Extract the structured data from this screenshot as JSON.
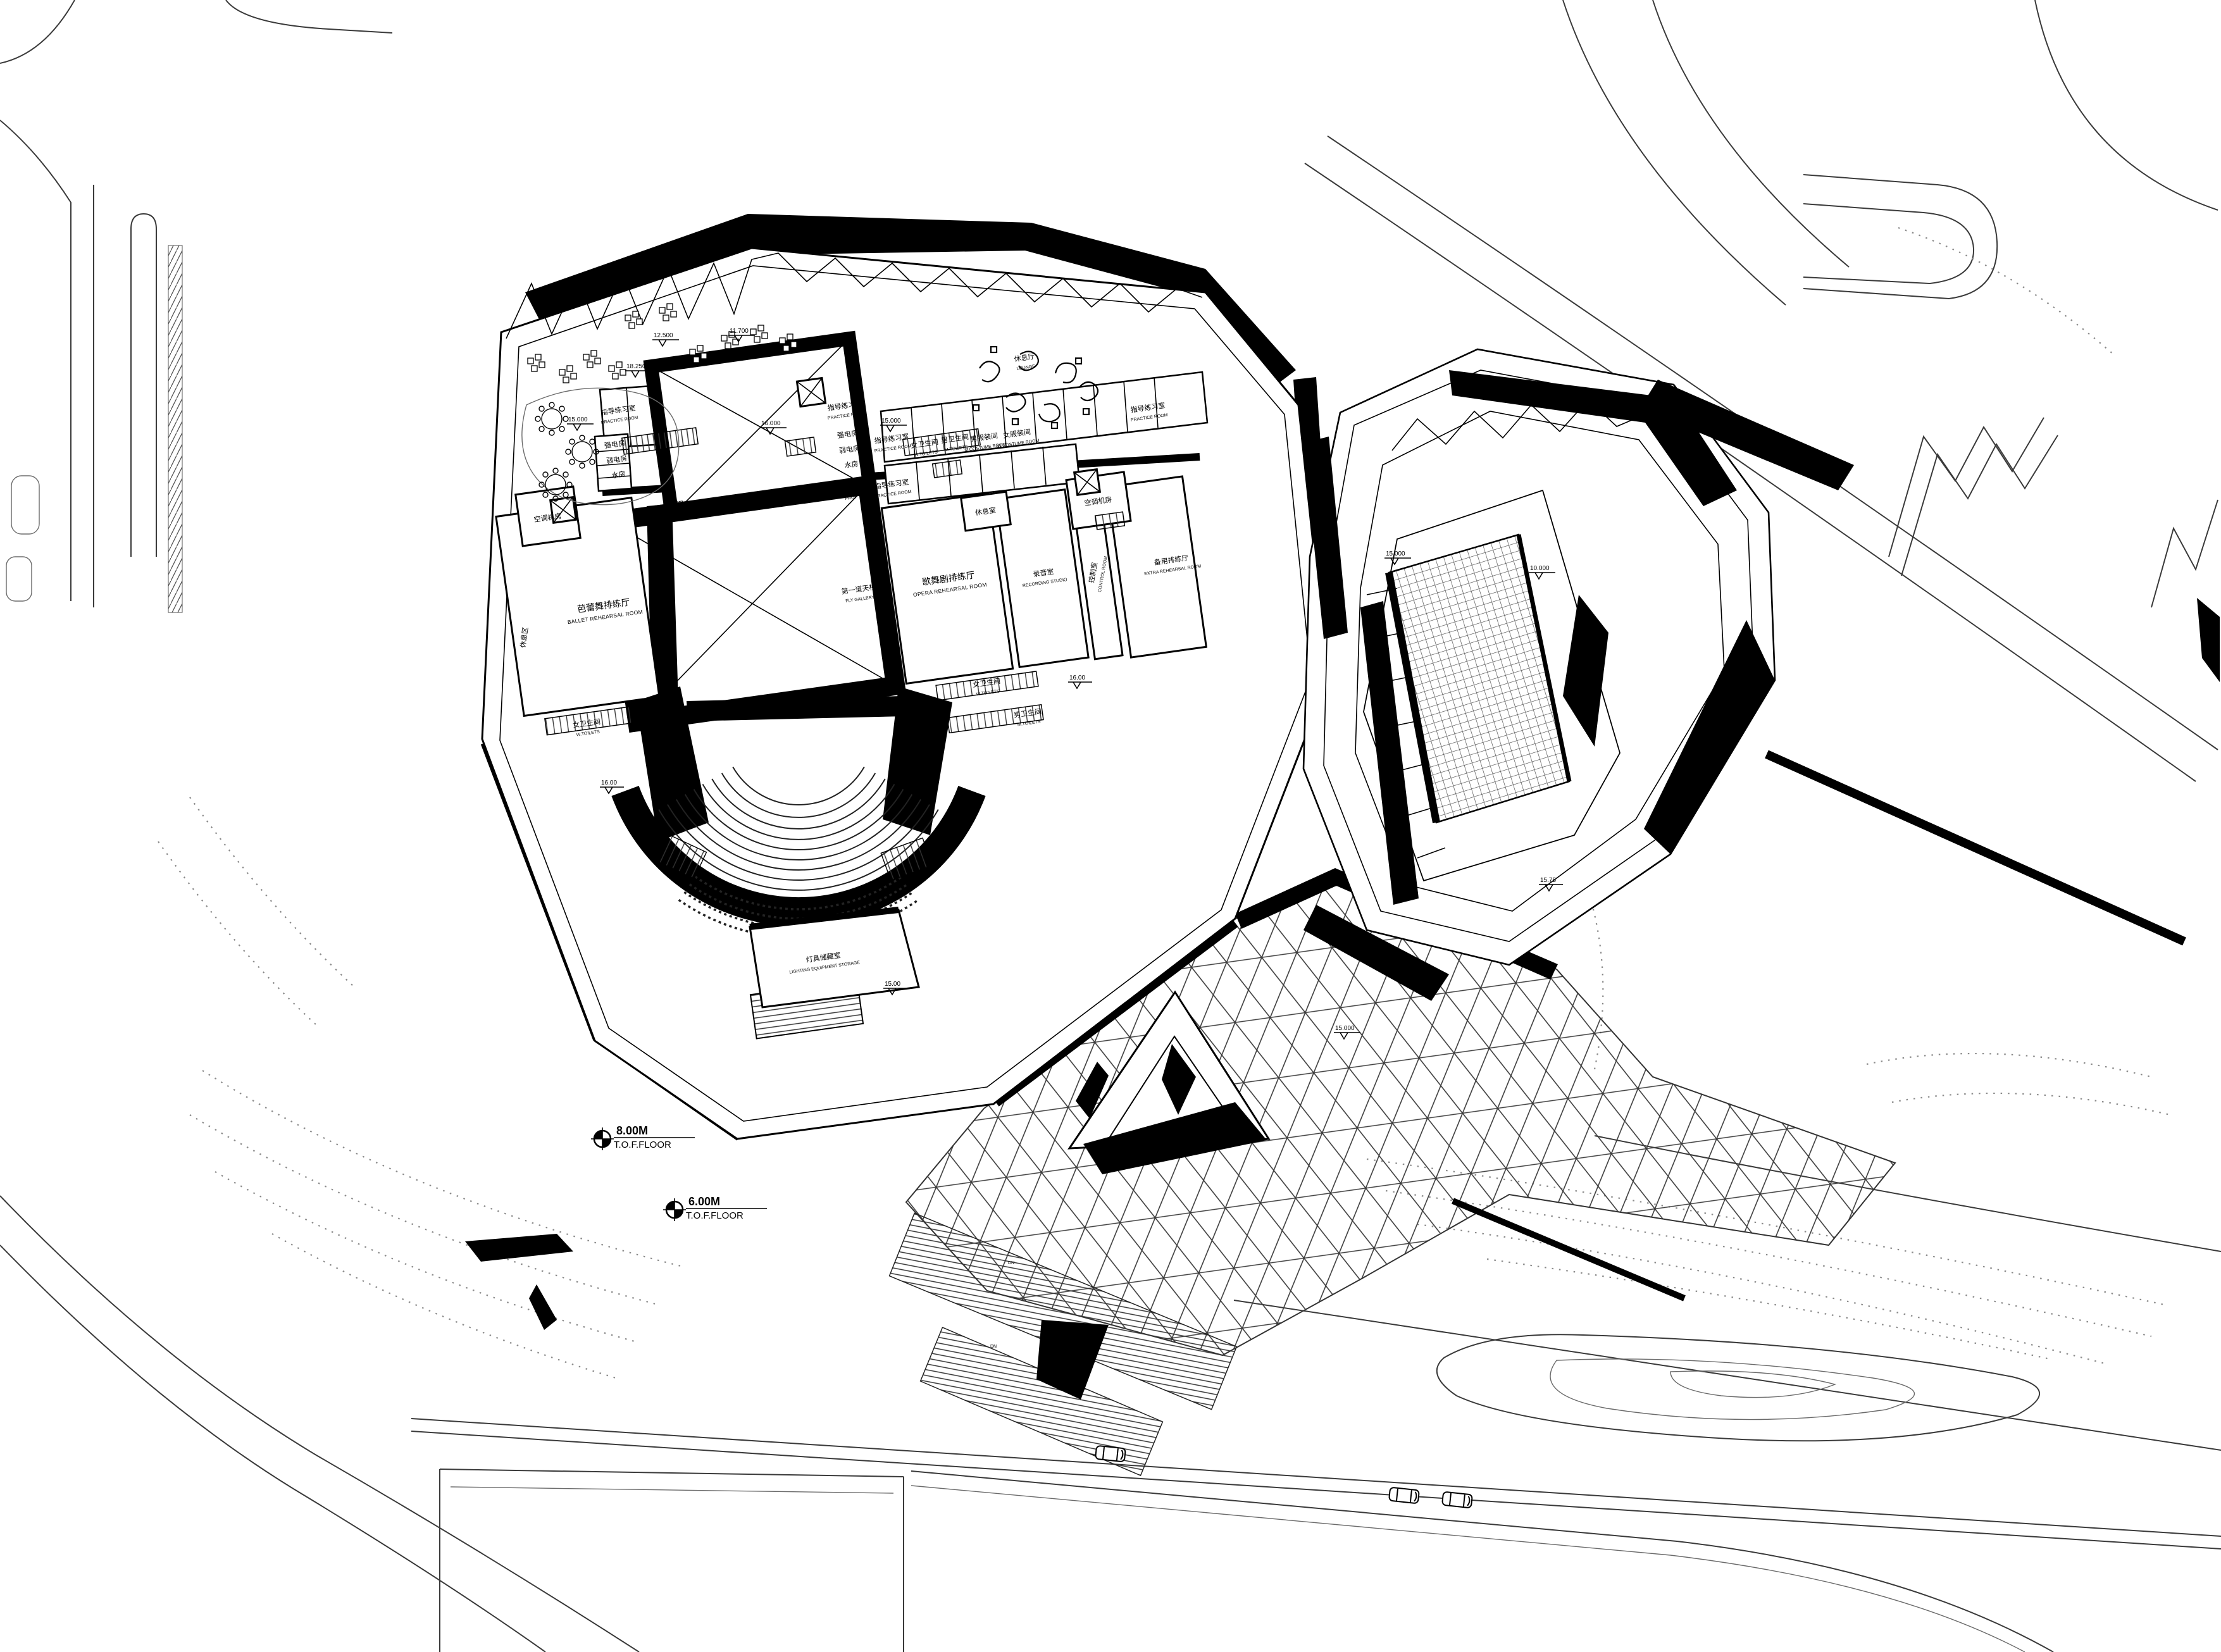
{
  "drawing": {
    "type": "architectural-site-plan",
    "ink_color": "#000000",
    "paper_color": "#ffffff"
  },
  "floor_markers": [
    {
      "value": "8.00M",
      "label": "T.O.F.FLOOR"
    },
    {
      "value": "6.00M",
      "label": "T.O.F.FLOOR"
    }
  ],
  "levels": [
    "15.000",
    "16.000",
    "15.000",
    "11.700",
    "12.500",
    "18.250",
    "16.00",
    "16.00",
    "15.00",
    "15.000",
    "15.000",
    "10.000",
    "15.75"
  ],
  "rooms": {
    "ballet": {
      "zh": "芭蕾舞排练厅",
      "en": "BALLET REHEARSAL ROOM"
    },
    "opera": {
      "zh": "歌舞剧排练厅",
      "en": "OPERA REHEARSAL ROOM"
    },
    "fly": {
      "zh": "第一道天桥",
      "en": "FLY GALLERY"
    },
    "recording": {
      "zh": "录音室",
      "en": "RECORDING STUDIO"
    },
    "control": {
      "zh": "控制室",
      "en": "CONTROL ROOM"
    },
    "extra": {
      "zh": "备用排练厅",
      "en": "EXTRA REHEARSAL ROOM"
    },
    "lighting": {
      "zh": "灯具储藏室",
      "en": "LIGHTING EQUIPMENT STORAGE"
    },
    "lounge": {
      "zh": "休息厅",
      "en": "LOUNGE"
    },
    "practice": {
      "zh": "指导练习室",
      "en": "PRACTICE ROOM"
    },
    "costume": {
      "zh": "服装间",
      "en": "COSTUME ROOM"
    },
    "mcostume": {
      "zh": "男服装间",
      "en": "M.COSTUME ROOM"
    },
    "wcostume": {
      "zh": "女服装间",
      "en": "W.COSTUME ROOM"
    },
    "wtoilet": {
      "zh": "女卫生间",
      "en": "W.TOILETS"
    },
    "mtoilet": {
      "zh": "男卫生间",
      "en": "M.TOILETS"
    },
    "prop": {
      "zh": "道具室",
      "en": "PROP"
    },
    "strong": {
      "zh": "强电房"
    },
    "weak": {
      "zh": "弱电房"
    },
    "water": {
      "zh": "水房"
    },
    "ac": {
      "zh": "空调机房"
    },
    "rest": {
      "zh": "休息室"
    },
    "restarea": {
      "zh": "休息区"
    },
    "down": {
      "zh": "下",
      "en": "DN"
    }
  }
}
